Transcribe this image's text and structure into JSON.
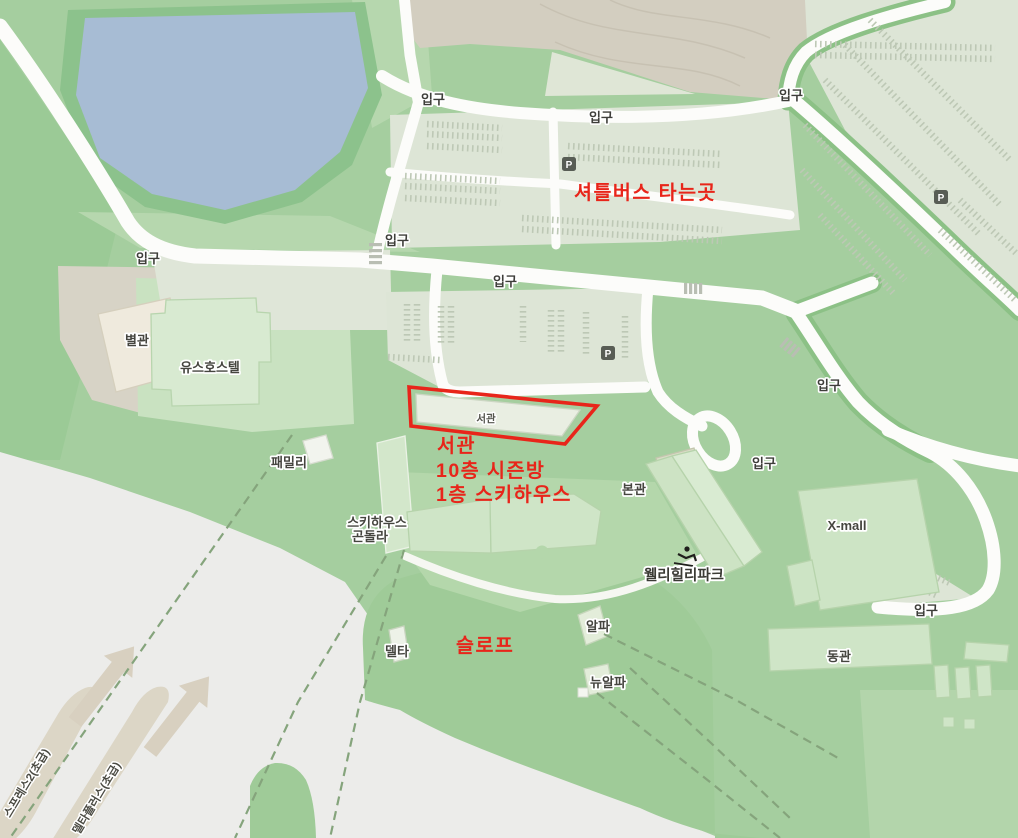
{
  "map": {
    "road_label": "입구",
    "parking_symbol": "P",
    "places": {
      "byeolgwan": "별관",
      "youth_hostel": "유스호스텔",
      "seogwan_building": "서관",
      "family": "패밀리",
      "skihouse_gondola_line1": "스키하우스",
      "skihouse_gondola_line2": "곤돌라",
      "bongwan": "본관",
      "wellihilli_park": "웰리힐리파크",
      "xmall": "X-mall",
      "donggwan": "동관",
      "delta": "델타",
      "alpha": "알파",
      "new_alpha": "뉴알파"
    },
    "trails": {
      "trail1": "스프레스2(초급)",
      "trail2": "델타플러스(초급)"
    }
  },
  "annotations": {
    "color": "#e8251a",
    "shuttle": "셔틀버스 타는곳",
    "seogwan_line1": "서관",
    "seogwan_line2": "10층 시즌방",
    "seogwan_line3": "1층 스키하우스",
    "slope": "슬로프"
  }
}
